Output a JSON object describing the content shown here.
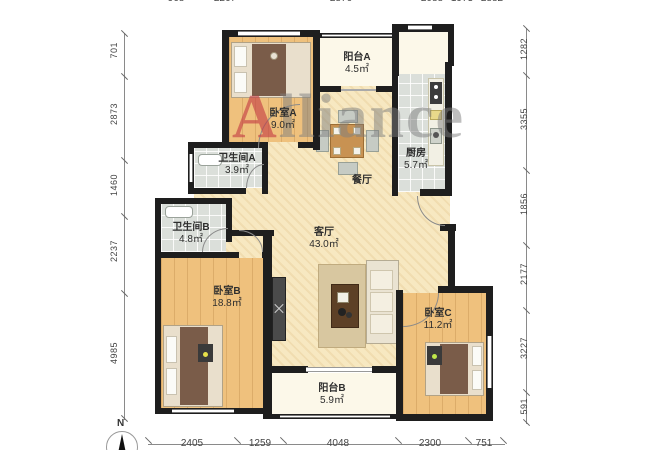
{
  "watermark": {
    "first_letter": "A",
    "rest": "lliance"
  },
  "compass": {
    "north_label": "N"
  },
  "rooms": [
    {
      "key": "balcony-a",
      "name": "阳台A",
      "area": "4.5㎡"
    },
    {
      "key": "bedroom-a",
      "name": "卧室A",
      "area": "9.0㎡"
    },
    {
      "key": "bathroom-a",
      "name": "卫生间A",
      "area": "3.9㎡"
    },
    {
      "key": "kitchen",
      "name": "厨房",
      "area": "5.7㎡"
    },
    {
      "key": "dining",
      "name": "餐厅",
      "area": ""
    },
    {
      "key": "living",
      "name": "客厅",
      "area": "43.0㎡"
    },
    {
      "key": "bathroom-b",
      "name": "卫生间B",
      "area": "4.8㎡"
    },
    {
      "key": "bedroom-b",
      "name": "卧室B",
      "area": "18.8㎡"
    },
    {
      "key": "bedroom-c",
      "name": "卧室C",
      "area": "11.2㎡"
    },
    {
      "key": "balcony-b",
      "name": "阳台B",
      "area": "5.9㎡"
    }
  ],
  "dimensions": {
    "left": [
      "701",
      "2873",
      "1460",
      "2237",
      "4985"
    ],
    "right": [
      "1282",
      "3355",
      "1856",
      "2177",
      "3227",
      "591"
    ],
    "bottom": [
      "2405",
      "1259",
      "4048",
      "2300",
      "751"
    ],
    "top": [
      "968",
      "2267",
      "2876",
      "2088",
      "1973",
      "2882"
    ]
  },
  "colors": {
    "wall": "#1e1e1e",
    "wood_floor": "#efc17d",
    "tile_floor": "#dbdfda",
    "living_floor": "#f7e8c1",
    "balcony_floor": "#fcf8e9",
    "watermark_gray": "#7d7d7d",
    "watermark_red": "#c33c44"
  }
}
